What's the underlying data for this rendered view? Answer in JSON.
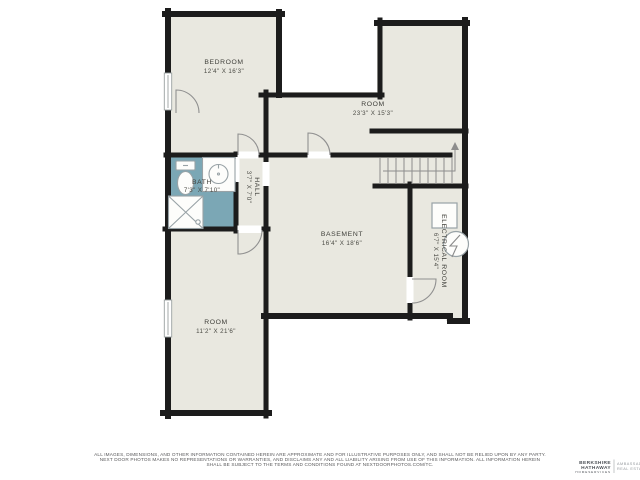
{
  "floorplan": {
    "rooms": [
      {
        "name": "BEDROOM",
        "dims": "12'4\" X 16'3\""
      },
      {
        "name": "ROOM",
        "dims": "23'3\" X 15'3\""
      },
      {
        "name": "BATH",
        "dims": "7'3\" X 7'10\""
      },
      {
        "name": "HALL",
        "dims": "3'7\" X 7'0\""
      },
      {
        "name": "BASEMENT",
        "dims": "16'4\" X 18'6\""
      },
      {
        "name": "ELECTRICAL ROOM",
        "dims": "6'7\" X 15'4\""
      },
      {
        "name": "ROOM",
        "dims": "11'2\" X 21'6\""
      }
    ],
    "colors": {
      "wall": "#1c1c1c",
      "floor": "#e9e8e0",
      "bath_floor": "#7ba7b5",
      "fixture_line": "#98a2a6",
      "stair_line": "#8d8d8d"
    }
  },
  "footer": {
    "line1": "ALL IMAGES, DIMENSIONS, AND OTHER INFORMATION CONTAINED HEREIN ARE APPROXIMATE AND FOR ILLUSTRATIVE PURPOSES ONLY, AND SHALL NOT BE RELIED UPON BY ANY PARTY.",
    "line2": "NEXT DOOR PHOTOS MAKES NO REPRESENTATIONS OR WARRANTIES, AND DISCLAIMS ANY AND ALL LIABILITY ARISING FROM USE OF THIS INFORMATION. ALL INFORMATION HEREIN",
    "line3": "SHALL BE SUBJECT TO THE TERMS AND CONDITIONS FOUND AT NEXTDOORPHOTOS.COM/TC."
  },
  "logo": {
    "brand_top": "BERKSHIRE",
    "brand_mid": "HATHAWAY",
    "brand_sub": "HOMESERVICES",
    "division_top": "AMBASSADOR",
    "division_bottom": "REAL ESTATE"
  }
}
